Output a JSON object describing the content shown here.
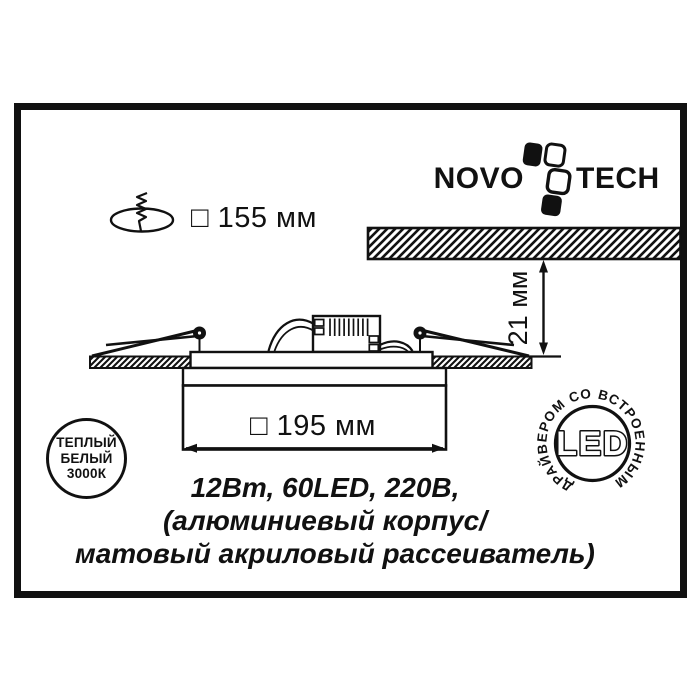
{
  "colors": {
    "ink": "#111111",
    "paper": "#ffffff"
  },
  "brand": {
    "wordmark_left": "NOVO",
    "wordmark_right": "TECH"
  },
  "dimensions": {
    "cutout_label": "□ 155 мм",
    "recess_depth_label": "21 мм",
    "width_label": "□ 195 мм"
  },
  "specs": {
    "line1": "12Вт, 60LED, 220В,",
    "line2": "(алюминиевый корпус/",
    "line3": "матовый акриловый рассеиватель)"
  },
  "badges": {
    "warm_white": {
      "line1": "ТЕПЛЫЙ",
      "line2": "БЕЛЫЙ",
      "line3": "3000К"
    },
    "led": {
      "center_label": "LED",
      "ring_label": "ДРАЙВЕРОМ СО ВСТРОЕННЫМ"
    }
  }
}
